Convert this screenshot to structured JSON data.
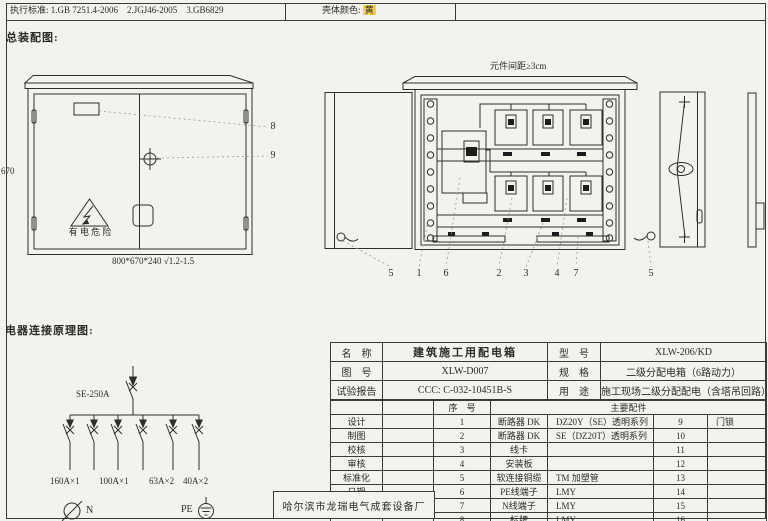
{
  "header": {
    "standards": "执行标准: 1.GB 7251.4-2006    2.JGJ46-2005    3.GB6829",
    "shell_color_label": "壳体颜色: ",
    "shell_color_value": "黄",
    "highlight_color": "#f0d24a"
  },
  "assembly": {
    "section_title": "总装配图:",
    "height_dim": "670",
    "size_note": "800*670*240 √1.2-1.5",
    "warning_text": "有 电 危 险",
    "callout_8": "8",
    "callout_9": "9"
  },
  "open_view": {
    "spacing_note": "元件间距≥3cm",
    "callouts": [
      "5",
      "1",
      "6",
      "2",
      "3",
      "4",
      "7",
      "5"
    ]
  },
  "schematic": {
    "section_title": "电器连接原理图:",
    "main_breaker": "SE-250A",
    "branch_labels": [
      "160A×1",
      "100A×1",
      "63A×2",
      "40A×2"
    ],
    "neutral_label": "N",
    "earth_label": "PE"
  },
  "title_block": {
    "info_rows": [
      {
        "k1": "名　称",
        "v1": "建筑施工用配电箱",
        "k2": "型　号",
        "v2": "XLW-206/KD"
      },
      {
        "k1": "图　号",
        "v1": "XLW-D007",
        "k2": "规　格",
        "v2": "二级分配电箱（6路动力）"
      },
      {
        "k1": "试验报告",
        "v1": "CCC: C-032-10451B-S",
        "k2": "用　途",
        "v2": "施工现场二级分配配电（含塔吊回路）"
      }
    ],
    "seq_header": "序　号",
    "parts_header": "主要配件",
    "rows": [
      {
        "role": "设计",
        "no": "1",
        "part": "断路器 DK",
        "spec": "DZ20Y（SE）透明系列",
        "no2": "9",
        "part2": "门锁"
      },
      {
        "role": "制图",
        "no": "2",
        "part": "断路器 DK",
        "spec": "SE（DZ20T）透明系列",
        "no2": "10",
        "part2": ""
      },
      {
        "role": "校核",
        "no": "3",
        "part": "线卡",
        "spec": "",
        "no2": "11",
        "part2": ""
      },
      {
        "role": "审核",
        "no": "4",
        "part": "安装板",
        "spec": "",
        "no2": "12",
        "part2": ""
      },
      {
        "role": "标准化",
        "no": "5",
        "part": "软连接铜缆",
        "spec": "TM 加塑管",
        "no2": "13",
        "part2": ""
      },
      {
        "role": "日期",
        "no": "6",
        "part": "PE线端子",
        "spec": "LMY",
        "no2": "14",
        "part2": ""
      },
      {
        "role": "",
        "no": "7",
        "part": "N线端子",
        "spec": "LMY",
        "no2": "15",
        "part2": ""
      },
      {
        "role": "",
        "no": "8",
        "part": "标牌",
        "spec": "LMY",
        "no2": "16",
        "part2": ""
      }
    ],
    "factory": "哈尔滨市龙瑞电气成套设备厂"
  }
}
